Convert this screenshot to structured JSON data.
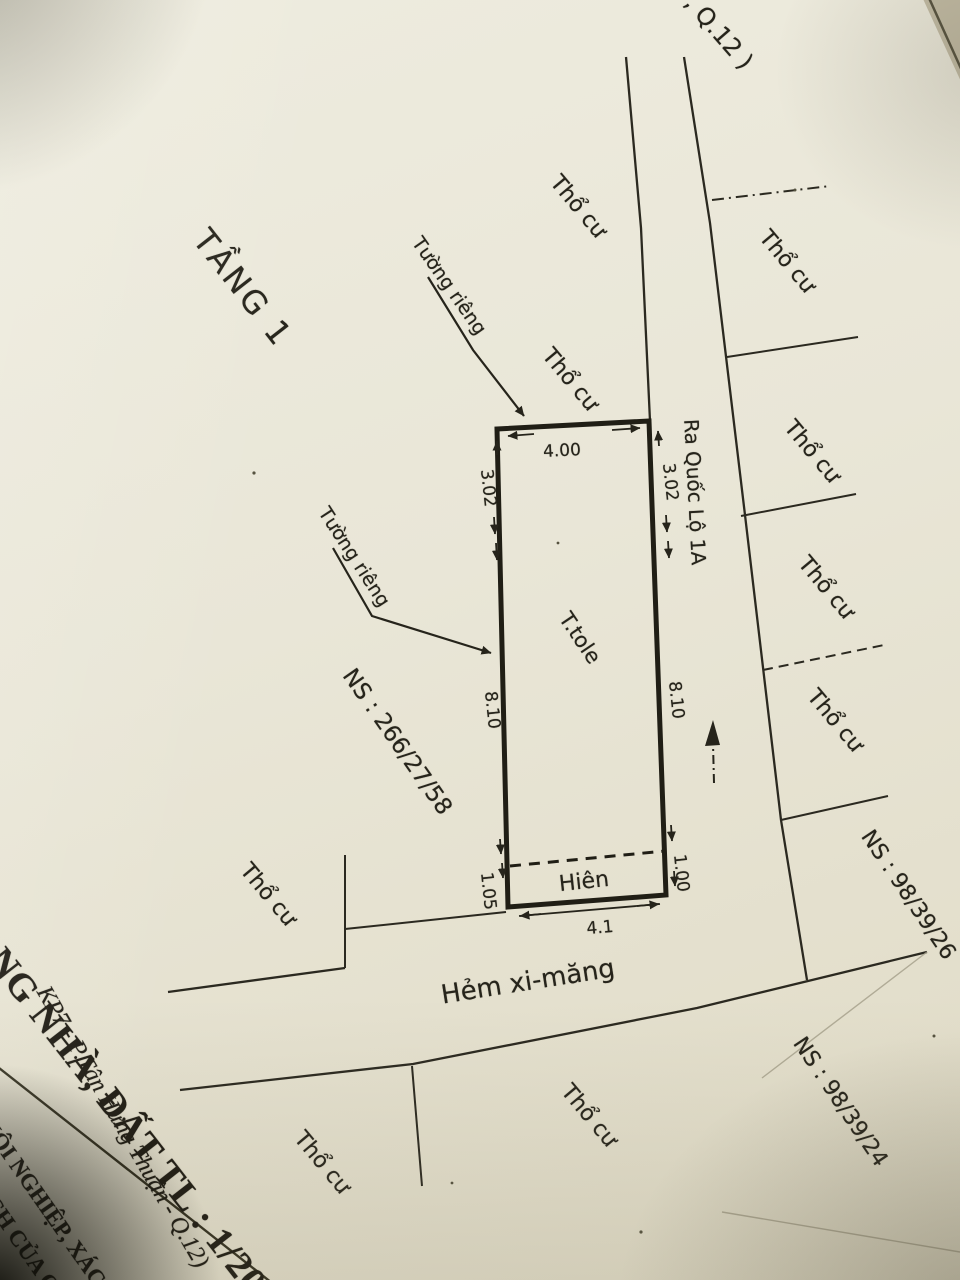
{
  "page": {
    "paper_color": "#e9e6d7",
    "ink_color": "#26241b"
  },
  "drawing": {
    "floor_label": "TẦNG 1",
    "map_fragment_top": ", Q.12 )",
    "road_label": "Ra Quốc Lộ 1A",
    "alley_label": "Hẻm xi-măng",
    "roof_label": "T.tole",
    "porch_label": "Hiên",
    "wall_note_upper": "Tường riêng",
    "wall_note_lower": "Tường riêng",
    "house_numbers": {
      "left": "NS : 266/27/58",
      "right_upper": "NS : 98/39/26",
      "right_lower": "NS : 98/39/24"
    },
    "parcel_labels": [
      "Thổ cư",
      "Thổ cư",
      "Thổ cư",
      "Thổ cư",
      "Thổ cư",
      "Thổ cư",
      "Thổ cư",
      "Thổ cư",
      "Thổ cư"
    ],
    "dimensions": {
      "top": "4.00",
      "left_upper": "3.02",
      "right_upper": "3.02",
      "left_middle": "8.10",
      "right_middle": "8.10",
      "right_lower": "1.00",
      "left_lower": "1.05",
      "bottom": "4.1"
    }
  },
  "title_block": {
    "title_fragment": "RẠNG NHÀ, ĐẤT TL : 1/200",
    "address_fragment": "KP7 - P.Tân Hưng Thuận - Q.12)",
    "note_fragment_1": "NỘI NGHIỆP, XÁC-N",
    "note_fragment_2": "ẠCH CỦA Q"
  }
}
